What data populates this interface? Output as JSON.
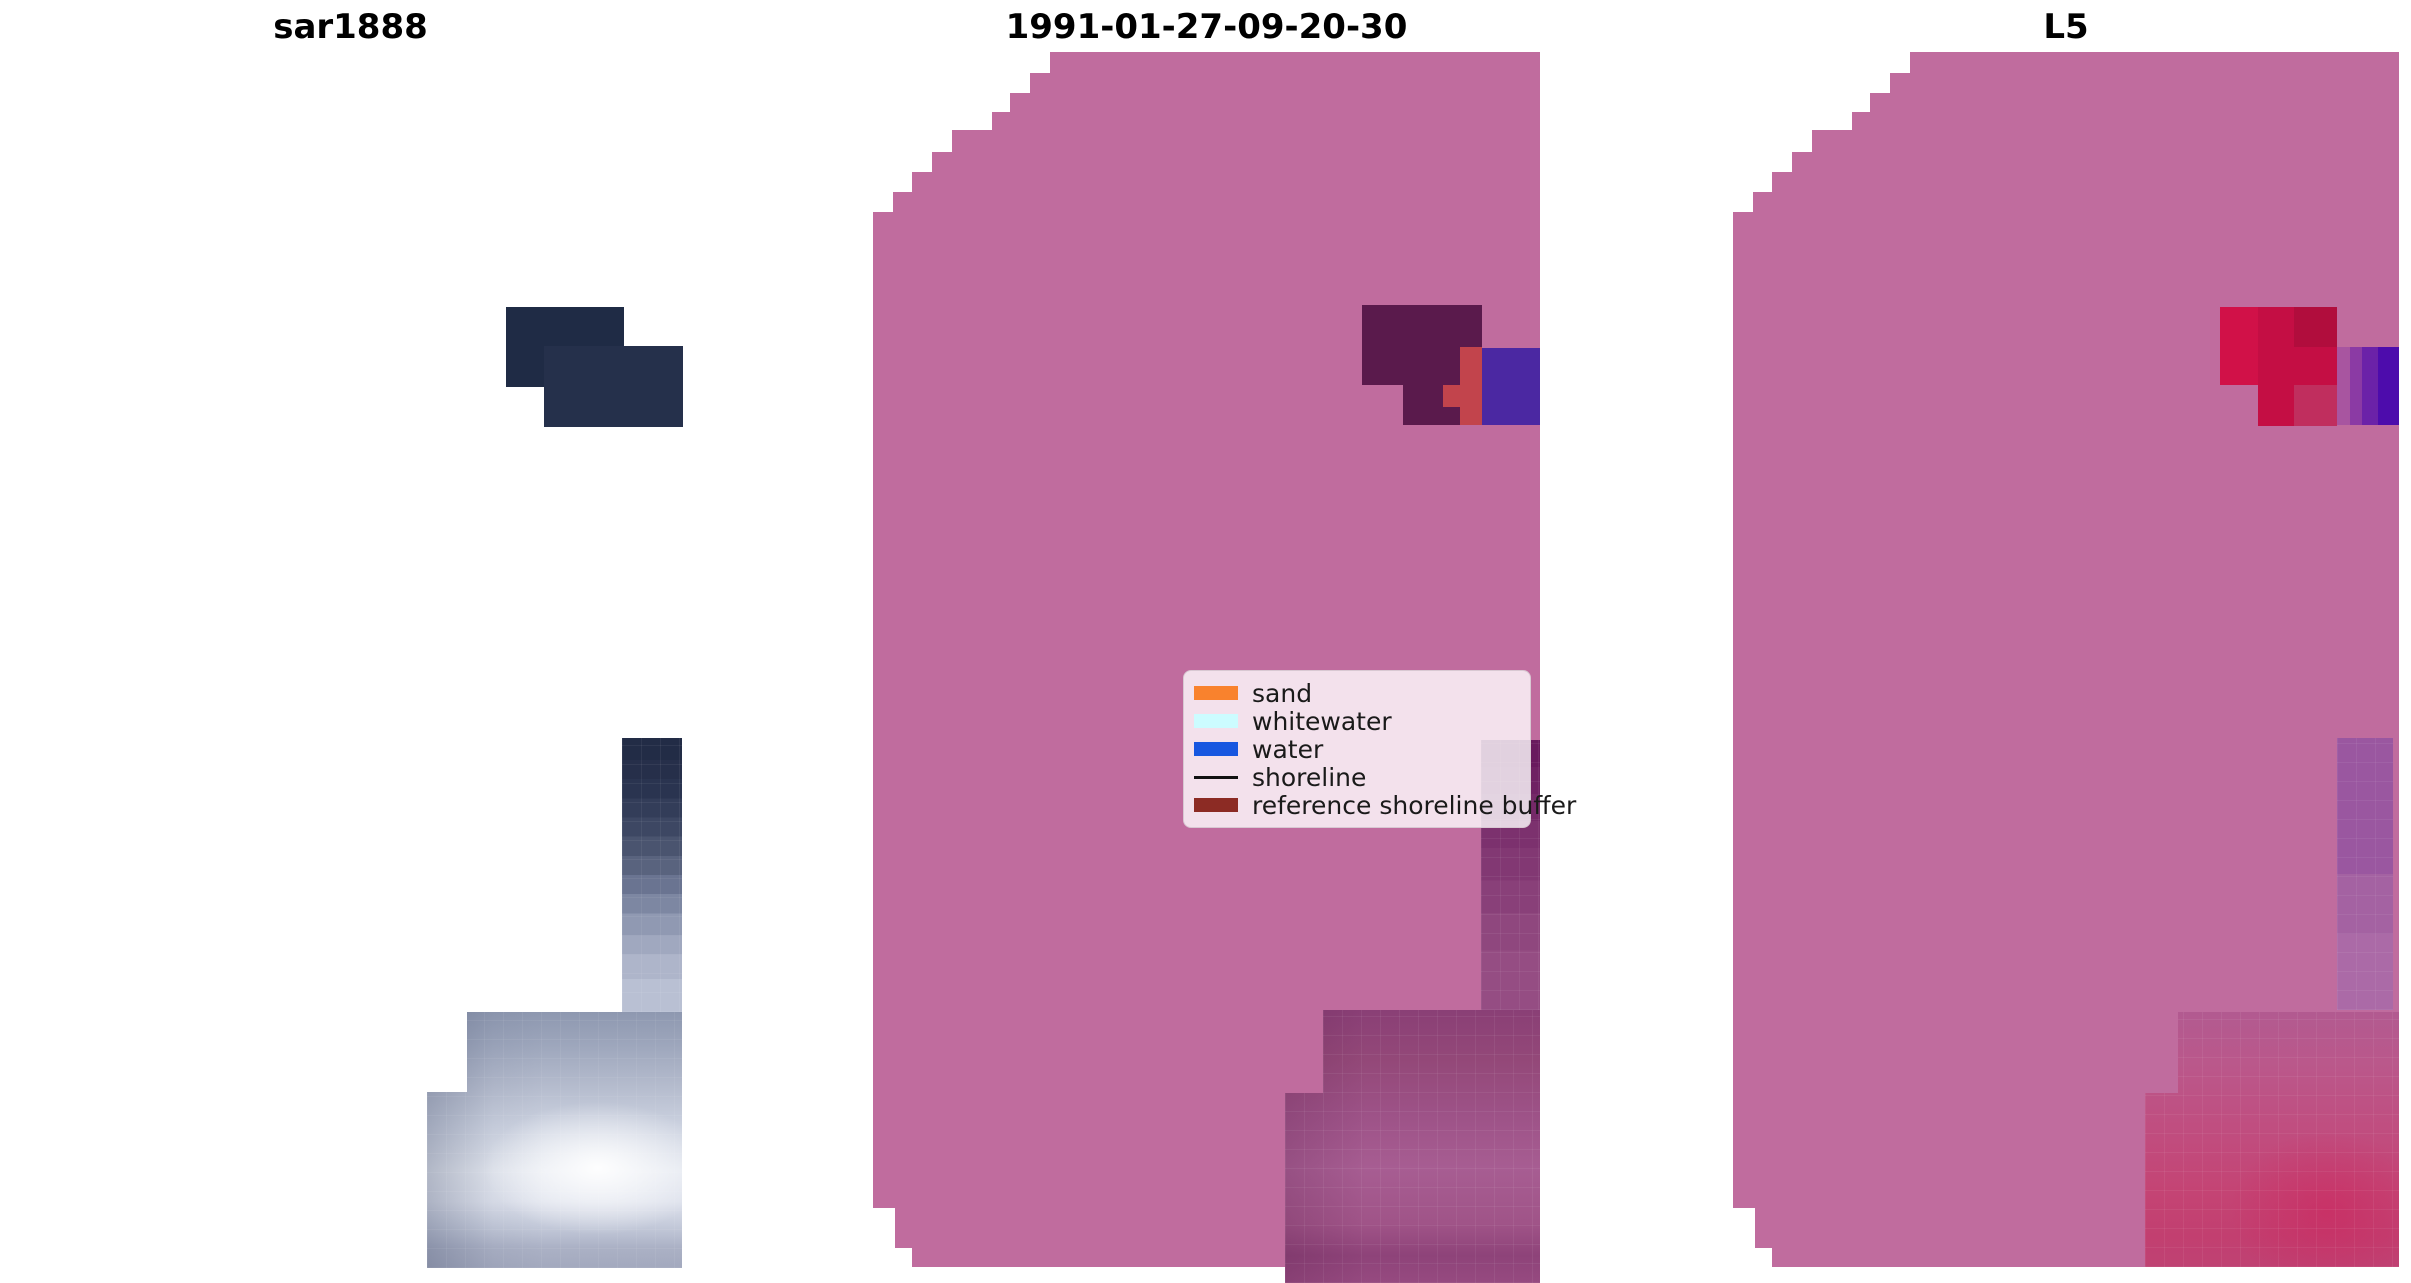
{
  "figure": {
    "panels": [
      {
        "id": "sar",
        "title": "sar1888"
      },
      {
        "id": "classified",
        "title": "1991-01-27-09-20-30"
      },
      {
        "id": "l5",
        "title": "L5"
      }
    ],
    "legend": {
      "items": [
        {
          "label": "sand",
          "color": "#f9822d",
          "marker": "patch"
        },
        {
          "label": "whitewater",
          "color": "#ccfcff",
          "marker": "patch"
        },
        {
          "label": "water",
          "color": "#1757e0",
          "marker": "patch"
        },
        {
          "label": "shoreline",
          "color": "#111111",
          "marker": "line"
        },
        {
          "label": "reference shoreline buffer",
          "color": "#8c2b24",
          "marker": "patch"
        }
      ]
    }
  },
  "colors": {
    "bg": "#ffffff",
    "title": "#000000",
    "legend_text": "#1a1a1a",
    "pink": "#c06c9e",
    "navy1": "#1f2b45",
    "navy2": "#25304b",
    "blob_purple": "#5a1a4c",
    "mid_red": "#c2444c",
    "mid_indigo": "#4b28a2",
    "crimson": "#c40e44",
    "crimson_light": "#d11148",
    "crimson_dark": "#b10d3d",
    "crimson_pink": "#c02e5e",
    "stripe1": "#a855a0",
    "stripe2": "#8b3aa4",
    "stripe3": "#6b22a8",
    "stripe4": "#4d0cac"
  },
  "chart_data": {
    "type": "heatmap",
    "title": "",
    "layout": "three image panels side by side, stair-stepped satellite swaths, white page background",
    "panels": [
      {
        "title": "sar1888",
        "description": "SAR backscatter swath rendered on white; only a dark navy return patch near the upper middle and a bright blue-gray gradient patch at the bottom right of the axes are visible",
        "regions": [
          {
            "name": "dark-sar-return-upper",
            "approx_bbox_px": [
              506,
              307,
              118,
              80
            ],
            "color": "#1f2b45"
          },
          {
            "name": "dark-sar-return-lower",
            "approx_bbox_px": [
              544,
              346,
              139,
              81
            ],
            "color": "#25304b"
          },
          {
            "name": "gradient-column-dark-to-light",
            "approx_bbox_px": [
              622,
              738,
              60,
              274
            ],
            "colors": [
              "#222c46",
              "#b9c0d3"
            ]
          },
          {
            "name": "bright-stepped-patch",
            "approx_bbox_px": [
              427,
              1012,
              255,
              256
            ],
            "colors": [
              "#8e98b0",
              "#eef1f7",
              "#a3a9be"
            ]
          }
        ]
      },
      {
        "title": "1991-01-27-09-20-30",
        "description": "Classified scene: magenta-pink swath (reference shoreline buffer area) with stair-stepped top-left and bottom-left edges; dark purple, red and indigo patches at top right; dark-purple-to-mauve gradient strip and mauve block at bottom right; legend box overlaid",
        "regions": [
          {
            "name": "dark-purple-patch",
            "approx_bbox_px": [
              1362,
              305,
              120,
              120
            ],
            "color": "#5a1a4c"
          },
          {
            "name": "red-patch",
            "approx_bbox_px": [
              1460,
              347,
              22,
              78
            ],
            "color": "#c2444c"
          },
          {
            "name": "indigo-patch",
            "approx_bbox_px": [
              1482,
              348,
              58,
              77
            ],
            "color": "#4b28a2"
          },
          {
            "name": "right-gradient-strip",
            "approx_bbox_px": [
              1481,
              740,
              59,
              270
            ],
            "colors": [
              "#691a5e",
              "#954d83"
            ]
          },
          {
            "name": "bottom-mauve-block",
            "approx_bbox_px": [
              1285,
              1010,
              255,
              273
            ],
            "colors": [
              "#8a3f76",
              "#a75d92",
              "#964a80"
            ]
          }
        ]
      },
      {
        "title": "L5",
        "description": "Landsat 5 scene: same pink swath clipped at the right edge of the axes; crimson patch with purple-to-indigo stripes at top right; light purple strip and pink-red gradient block at bottom right",
        "regions": [
          {
            "name": "crimson-patch",
            "approx_bbox_px": [
              2220,
              307,
              117,
              119
            ],
            "colors": [
              "#d11148",
              "#c40e44",
              "#b10d3d"
            ]
          },
          {
            "name": "purple-stripes",
            "approx_bbox_px": [
              2337,
              347,
              62,
              78
            ],
            "colors": [
              "#a855a0",
              "#8b3aa4",
              "#6b22a8",
              "#4d0cac"
            ]
          },
          {
            "name": "right-light-purple-strip",
            "approx_bbox_px": [
              2337,
              738,
              56,
              272
            ],
            "colors": [
              "#9a57a0",
              "#ab6aa7"
            ]
          },
          {
            "name": "bottom-pink-red-block",
            "approx_bbox_px": [
              2145,
              1012,
              254,
              255
            ],
            "colors": [
              "#b25a90",
              "#c44474"
            ]
          }
        ]
      }
    ],
    "legend": {
      "position": "overlaid on middle panel, center-right",
      "entries": [
        {
          "label": "sand",
          "color": "#f9822d",
          "marker": "patch"
        },
        {
          "label": "whitewater",
          "color": "#ccfcff",
          "marker": "patch"
        },
        {
          "label": "water",
          "color": "#1757e0",
          "marker": "patch"
        },
        {
          "label": "shoreline",
          "color": "#111111",
          "marker": "line"
        },
        {
          "label": "reference shoreline buffer",
          "color": "#8c2b24",
          "marker": "patch"
        }
      ]
    }
  }
}
